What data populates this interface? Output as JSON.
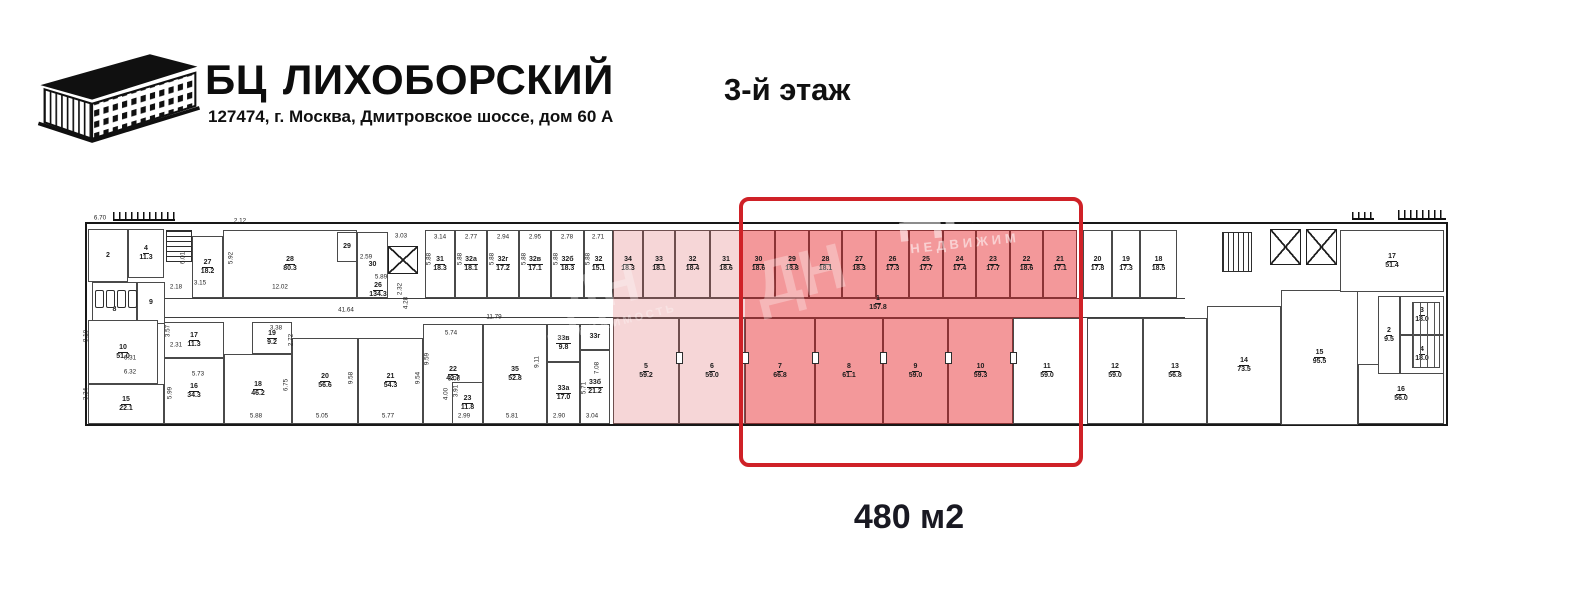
{
  "header": {
    "brand_prefix": "БЦ",
    "brand_name": "ЛИХОБОРСКИЙ",
    "address": "127474, г. Москва, Дмитровское шоссе, дом 60 А",
    "floor_title": "3-й этаж"
  },
  "callout": {
    "area_label": "480 м2"
  },
  "colors": {
    "highlight_border": "#cf2127",
    "room_red_fill": "#f3989a",
    "room_pink_fill": "#f6d6d7",
    "wall": "#3e3e3e"
  },
  "watermarks": [
    {
      "text": "ДН",
      "x": 940,
      "y": 205,
      "size": 60,
      "rot": -6,
      "opacity": 0.5,
      "ls": 0
    },
    {
      "text": "НЕДВИЖИМ",
      "x": 965,
      "y": 243,
      "size": 13,
      "rot": -6,
      "opacity": 0.55,
      "ls": 4
    },
    {
      "text": "ДН",
      "x": 800,
      "y": 275,
      "size": 64,
      "rot": -14,
      "opacity": 0.3,
      "ls": 0
    },
    {
      "text": "ДН",
      "x": 600,
      "y": 290,
      "size": 54,
      "rot": -14,
      "opacity": 0.3,
      "ls": 0
    },
    {
      "text": "НЕДВИЖИМОСТЬ",
      "x": 612,
      "y": 324,
      "size": 11,
      "rot": -14,
      "opacity": 0.32,
      "ls": 3
    }
  ],
  "plan": {
    "outline": {
      "x": 85,
      "y": 222,
      "w": 1363,
      "h": 204
    },
    "highlight": {
      "x": 739,
      "y": 197,
      "w": 344,
      "h": 270
    },
    "corridors": [
      {
        "x": 165,
        "y": 298,
        "w": 448,
        "h": 20,
        "f": "w"
      },
      {
        "x": 613,
        "y": 298,
        "w": 132,
        "h": 20,
        "f": "p"
      },
      {
        "x": 745,
        "y": 298,
        "w": 336,
        "h": 20,
        "f": "r"
      },
      {
        "x": 1081,
        "y": 298,
        "w": 104,
        "h": 20,
        "f": "w"
      }
    ],
    "rooms": [
      {
        "n": "2",
        "a": "",
        "x": 88,
        "y": 229,
        "w": 40,
        "h": 53,
        "f": "w"
      },
      {
        "n": "4",
        "a": "11.3",
        "x": 128,
        "y": 229,
        "w": 36,
        "h": 49,
        "f": "w"
      },
      {
        "n": "8",
        "a": "",
        "x": 92,
        "y": 282,
        "w": 45,
        "h": 56,
        "f": "w"
      },
      {
        "n": "9",
        "a": "",
        "x": 137,
        "y": 282,
        "w": 28,
        "h": 42,
        "f": "w"
      },
      {
        "n": "27",
        "a": "18.2",
        "x": 192,
        "y": 236,
        "w": 31,
        "h": 62,
        "f": "w"
      },
      {
        "n": "28",
        "a": "80.3",
        "x": 223,
        "y": 230,
        "w": 134,
        "h": 68,
        "f": "w"
      },
      {
        "n": "29",
        "a": "",
        "x": 337,
        "y": 232,
        "w": 20,
        "h": 30,
        "f": "w"
      },
      {
        "n": "30",
        "a": "",
        "x": 357,
        "y": 232,
        "w": 31,
        "h": 66,
        "f": "w"
      },
      {
        "n": "10",
        "a": "51.0",
        "x": 88,
        "y": 320,
        "w": 70,
        "h": 64,
        "f": "w"
      },
      {
        "n": "15",
        "a": "22.1",
        "x": 88,
        "y": 384,
        "w": 76,
        "h": 40,
        "f": "w"
      },
      {
        "n": "17",
        "a": "11.3",
        "x": 164,
        "y": 322,
        "w": 60,
        "h": 36,
        "f": "w"
      },
      {
        "n": "16",
        "a": "34.3",
        "x": 164,
        "y": 358,
        "w": 60,
        "h": 66,
        "f": "w"
      },
      {
        "n": "18",
        "a": "46.2",
        "x": 224,
        "y": 354,
        "w": 68,
        "h": 70,
        "f": "w"
      },
      {
        "n": "19",
        "a": "9.2",
        "x": 252,
        "y": 322,
        "w": 40,
        "h": 32,
        "f": "w"
      },
      {
        "n": "20",
        "a": "56.6",
        "x": 292,
        "y": 338,
        "w": 66,
        "h": 86,
        "f": "w"
      },
      {
        "n": "21",
        "a": "54.3",
        "x": 358,
        "y": 338,
        "w": 65,
        "h": 86,
        "f": "w"
      },
      {
        "n": "22",
        "a": "42.7",
        "x": 423,
        "y": 324,
        "w": 60,
        "h": 100,
        "f": "w"
      },
      {
        "n": "23",
        "a": "11.8",
        "x": 452,
        "y": 382,
        "w": 31,
        "h": 42,
        "f": "w"
      },
      {
        "n": "35",
        "a": "52.8",
        "x": 483,
        "y": 324,
        "w": 64,
        "h": 100,
        "f": "w"
      },
      {
        "n": "33в",
        "a": "9.8",
        "x": 547,
        "y": 324,
        "w": 33,
        "h": 38,
        "f": "w"
      },
      {
        "n": "33г",
        "a": "",
        "x": 580,
        "y": 324,
        "w": 30,
        "h": 26,
        "f": "w"
      },
      {
        "n": "33а",
        "a": "17.0",
        "x": 547,
        "y": 362,
        "w": 33,
        "h": 62,
        "f": "w"
      },
      {
        "n": "33б",
        "a": "21.2",
        "x": 580,
        "y": 350,
        "w": 30,
        "h": 74,
        "f": "w"
      },
      {
        "n": "31",
        "a": "18.3",
        "x": 425,
        "y": 230,
        "w": 30,
        "h": 68,
        "f": "w"
      },
      {
        "n": "32а",
        "a": "18.1",
        "x": 455,
        "y": 230,
        "w": 32,
        "h": 68,
        "f": "w"
      },
      {
        "n": "32г",
        "a": "17.2",
        "x": 487,
        "y": 230,
        "w": 32,
        "h": 68,
        "f": "w"
      },
      {
        "n": "32в",
        "a": "17.1",
        "x": 519,
        "y": 230,
        "w": 32,
        "h": 68,
        "f": "w"
      },
      {
        "n": "32б",
        "a": "18.3",
        "x": 551,
        "y": 230,
        "w": 33,
        "h": 68,
        "f": "w"
      },
      {
        "n": "32",
        "a": "15.1",
        "x": 584,
        "y": 230,
        "w": 29,
        "h": 68,
        "f": "w"
      },
      {
        "n": "34",
        "a": "18.3",
        "x": 613,
        "y": 230,
        "w": 30,
        "h": 68,
        "f": "p"
      },
      {
        "n": "33",
        "a": "18.1",
        "x": 643,
        "y": 230,
        "w": 32,
        "h": 68,
        "f": "p"
      },
      {
        "n": "32",
        "a": "18.4",
        "x": 675,
        "y": 230,
        "w": 35,
        "h": 68,
        "f": "p"
      },
      {
        "n": "31",
        "a": "18.6",
        "x": 710,
        "y": 230,
        "w": 32,
        "h": 68,
        "f": "p"
      },
      {
        "n": "30",
        "a": "18.6",
        "x": 742,
        "y": 230,
        "w": 33,
        "h": 68,
        "f": "r"
      },
      {
        "n": "29",
        "a": "18.8",
        "x": 775,
        "y": 230,
        "w": 34,
        "h": 68,
        "f": "r"
      },
      {
        "n": "28",
        "a": "18.1",
        "x": 809,
        "y": 230,
        "w": 33,
        "h": 68,
        "f": "r"
      },
      {
        "n": "27",
        "a": "18.3",
        "x": 842,
        "y": 230,
        "w": 34,
        "h": 68,
        "f": "r"
      },
      {
        "n": "26",
        "a": "17.3",
        "x": 876,
        "y": 230,
        "w": 33,
        "h": 68,
        "f": "r"
      },
      {
        "n": "25",
        "a": "17.7",
        "x": 909,
        "y": 230,
        "w": 34,
        "h": 68,
        "f": "r"
      },
      {
        "n": "24",
        "a": "17.4",
        "x": 943,
        "y": 230,
        "w": 33,
        "h": 68,
        "f": "r"
      },
      {
        "n": "23",
        "a": "17.7",
        "x": 976,
        "y": 230,
        "w": 34,
        "h": 68,
        "f": "r"
      },
      {
        "n": "22",
        "a": "18.6",
        "x": 1010,
        "y": 230,
        "w": 33,
        "h": 68,
        "f": "r"
      },
      {
        "n": "21",
        "a": "17.1",
        "x": 1043,
        "y": 230,
        "w": 34,
        "h": 68,
        "f": "r"
      },
      {
        "n": "20",
        "a": "17.8",
        "x": 1083,
        "y": 230,
        "w": 29,
        "h": 68,
        "f": "w"
      },
      {
        "n": "19",
        "a": "17.3",
        "x": 1112,
        "y": 230,
        "w": 28,
        "h": 68,
        "f": "w"
      },
      {
        "n": "18",
        "a": "18.5",
        "x": 1140,
        "y": 230,
        "w": 37,
        "h": 68,
        "f": "w"
      },
      {
        "n": "5",
        "a": "59.2",
        "x": 613,
        "y": 318,
        "w": 66,
        "h": 106,
        "f": "p"
      },
      {
        "n": "6",
        "a": "59.0",
        "x": 679,
        "y": 318,
        "w": 66,
        "h": 106,
        "f": "p"
      },
      {
        "n": "7",
        "a": "66.8",
        "x": 745,
        "y": 318,
        "w": 70,
        "h": 106,
        "f": "r"
      },
      {
        "n": "8",
        "a": "61.1",
        "x": 815,
        "y": 318,
        "w": 68,
        "h": 106,
        "f": "r"
      },
      {
        "n": "9",
        "a": "59.0",
        "x": 883,
        "y": 318,
        "w": 65,
        "h": 106,
        "f": "r"
      },
      {
        "n": "10",
        "a": "59.3",
        "x": 948,
        "y": 318,
        "w": 65,
        "h": 106,
        "f": "r"
      },
      {
        "n": "11",
        "a": "59.0",
        "x": 1013,
        "y": 318,
        "w": 68,
        "h": 106,
        "f": "w"
      },
      {
        "n": "12",
        "a": "59.0",
        "x": 1087,
        "y": 318,
        "w": 56,
        "h": 106,
        "f": "w"
      },
      {
        "n": "13",
        "a": "56.8",
        "x": 1143,
        "y": 318,
        "w": 64,
        "h": 106,
        "f": "w"
      },
      {
        "n": "14",
        "a": "73.5",
        "x": 1207,
        "y": 306,
        "w": 74,
        "h": 118,
        "f": "w"
      },
      {
        "n": "15",
        "a": "95.5",
        "x": 1281,
        "y": 290,
        "w": 77,
        "h": 135,
        "f": "w"
      },
      {
        "n": "16",
        "a": "56.0",
        "x": 1358,
        "y": 364,
        "w": 86,
        "h": 60,
        "f": "w"
      },
      {
        "n": "17",
        "a": "51.4",
        "x": 1340,
        "y": 230,
        "w": 104,
        "h": 62,
        "f": "w"
      },
      {
        "n": "2",
        "a": "9.5",
        "x": 1378,
        "y": 296,
        "w": 22,
        "h": 78,
        "f": "w"
      },
      {
        "n": "3",
        "a": "18.0",
        "x": 1400,
        "y": 296,
        "w": 44,
        "h": 39,
        "f": "w"
      },
      {
        "n": "4",
        "a": "18.0",
        "x": 1400,
        "y": 335,
        "w": 44,
        "h": 39,
        "f": "w"
      },
      {
        "n": "26",
        "a": "134.3",
        "x": 358,
        "y": 282,
        "w": 40,
        "h": 16,
        "f": "n"
      },
      {
        "n": "1",
        "a": "157.8",
        "x": 856,
        "y": 294,
        "w": 44,
        "h": 18,
        "f": "n"
      }
    ],
    "features": [
      {
        "type": "stairs",
        "dir": "h",
        "x": 166,
        "y": 230,
        "w": 26,
        "h": 32
      },
      {
        "type": "stairs",
        "dir": "v",
        "x": 1222,
        "y": 232,
        "w": 30,
        "h": 40
      },
      {
        "type": "xbox",
        "x": 388,
        "y": 246,
        "w": 30,
        "h": 28
      },
      {
        "type": "xbox",
        "x": 1270,
        "y": 229,
        "w": 31,
        "h": 36
      },
      {
        "type": "xbox",
        "x": 1306,
        "y": 229,
        "w": 31,
        "h": 36
      },
      {
        "type": "comb",
        "x": 113,
        "y": 212,
        "w": 62,
        "h": 9
      },
      {
        "type": "comb",
        "x": 1352,
        "y": 212,
        "w": 22,
        "h": 8
      },
      {
        "type": "comb",
        "x": 1398,
        "y": 210,
        "w": 48,
        "h": 10
      },
      {
        "type": "radiator",
        "x": 1412,
        "y": 302,
        "w": 28,
        "h": 66
      },
      {
        "type": "wc",
        "x": 95,
        "y": 290,
        "w": 9,
        "h": 18
      },
      {
        "type": "wc",
        "x": 106,
        "y": 290,
        "w": 9,
        "h": 18
      },
      {
        "type": "wc",
        "x": 117,
        "y": 290,
        "w": 9,
        "h": 18
      },
      {
        "type": "wc",
        "x": 128,
        "y": 290,
        "w": 9,
        "h": 18
      },
      {
        "type": "door",
        "x": 676,
        "y": 352
      },
      {
        "type": "door",
        "x": 742,
        "y": 352
      },
      {
        "type": "door",
        "x": 812,
        "y": 352
      },
      {
        "type": "door",
        "x": 880,
        "y": 352
      },
      {
        "type": "door",
        "x": 945,
        "y": 352
      },
      {
        "type": "door",
        "x": 1010,
        "y": 352
      }
    ],
    "dims": [
      {
        "t": "6.70",
        "x": 100,
        "y": 218
      },
      {
        "t": "2.12",
        "x": 240,
        "y": 221
      },
      {
        "t": "6.01",
        "x": 183,
        "y": 258,
        "v": 1
      },
      {
        "t": "5.92",
        "x": 231,
        "y": 258,
        "v": 1
      },
      {
        "t": "2.18",
        "x": 176,
        "y": 287
      },
      {
        "t": "3.15",
        "x": 200,
        "y": 283
      },
      {
        "t": "12.02",
        "x": 280,
        "y": 287
      },
      {
        "t": "2.59",
        "x": 366,
        "y": 257
      },
      {
        "t": "3.03",
        "x": 401,
        "y": 236
      },
      {
        "t": "5.89",
        "x": 381,
        "y": 277
      },
      {
        "t": "2.32",
        "x": 400,
        "y": 289,
        "v": 1
      },
      {
        "t": "41.64",
        "x": 346,
        "y": 310
      },
      {
        "t": "4.28",
        "x": 406,
        "y": 303,
        "v": 1
      },
      {
        "t": "3.14",
        "x": 440,
        "y": 237
      },
      {
        "t": "2.77",
        "x": 471,
        "y": 237
      },
      {
        "t": "2.94",
        "x": 503,
        "y": 237
      },
      {
        "t": "2.95",
        "x": 535,
        "y": 237
      },
      {
        "t": "2.78",
        "x": 567,
        "y": 237
      },
      {
        "t": "2.71",
        "x": 598,
        "y": 237
      },
      {
        "t": "5.88",
        "x": 429,
        "y": 259,
        "v": 1
      },
      {
        "t": "5.88",
        "x": 460,
        "y": 259,
        "v": 1
      },
      {
        "t": "5.88",
        "x": 492,
        "y": 259,
        "v": 1
      },
      {
        "t": "5.88",
        "x": 524,
        "y": 259,
        "v": 1
      },
      {
        "t": "5.88",
        "x": 556,
        "y": 259,
        "v": 1
      },
      {
        "t": "5.88",
        "x": 588,
        "y": 259,
        "v": 1
      },
      {
        "t": "8.10",
        "x": 86,
        "y": 336,
        "v": 1
      },
      {
        "t": "6.31",
        "x": 130,
        "y": 358
      },
      {
        "t": "6.32",
        "x": 130,
        "y": 372
      },
      {
        "t": "3.34",
        "x": 86,
        "y": 394,
        "v": 1
      },
      {
        "t": "3.57",
        "x": 168,
        "y": 331,
        "v": 1
      },
      {
        "t": "2.31",
        "x": 176,
        "y": 345
      },
      {
        "t": "5.73",
        "x": 198,
        "y": 374
      },
      {
        "t": "5.99",
        "x": 170,
        "y": 393,
        "v": 1
      },
      {
        "t": "3.38",
        "x": 276,
        "y": 328
      },
      {
        "t": "2.72",
        "x": 291,
        "y": 340,
        "v": 1
      },
      {
        "t": "6.75",
        "x": 286,
        "y": 385,
        "v": 1
      },
      {
        "t": "9.58",
        "x": 351,
        "y": 378,
        "v": 1
      },
      {
        "t": "9.54",
        "x": 418,
        "y": 378,
        "v": 1
      },
      {
        "t": "11.79",
        "x": 494,
        "y": 317
      },
      {
        "t": "5.74",
        "x": 451,
        "y": 333
      },
      {
        "t": "9.59",
        "x": 427,
        "y": 359,
        "v": 1
      },
      {
        "t": "3.08",
        "x": 454,
        "y": 379
      },
      {
        "t": "4.00",
        "x": 446,
        "y": 394,
        "v": 1
      },
      {
        "t": "3.91",
        "x": 456,
        "y": 391,
        "v": 1
      },
      {
        "t": "9.11",
        "x": 537,
        "y": 362,
        "v": 1
      },
      {
        "t": "5.71",
        "x": 584,
        "y": 388,
        "v": 1
      },
      {
        "t": "7.08",
        "x": 597,
        "y": 368,
        "v": 1
      },
      {
        "t": "5.88",
        "x": 256,
        "y": 416
      },
      {
        "t": "5.05",
        "x": 322,
        "y": 416
      },
      {
        "t": "5.77",
        "x": 388,
        "y": 416
      },
      {
        "t": "2.99",
        "x": 464,
        "y": 416
      },
      {
        "t": "5.81",
        "x": 512,
        "y": 416
      },
      {
        "t": "2.90",
        "x": 559,
        "y": 416
      },
      {
        "t": "3.04",
        "x": 592,
        "y": 416
      }
    ]
  }
}
